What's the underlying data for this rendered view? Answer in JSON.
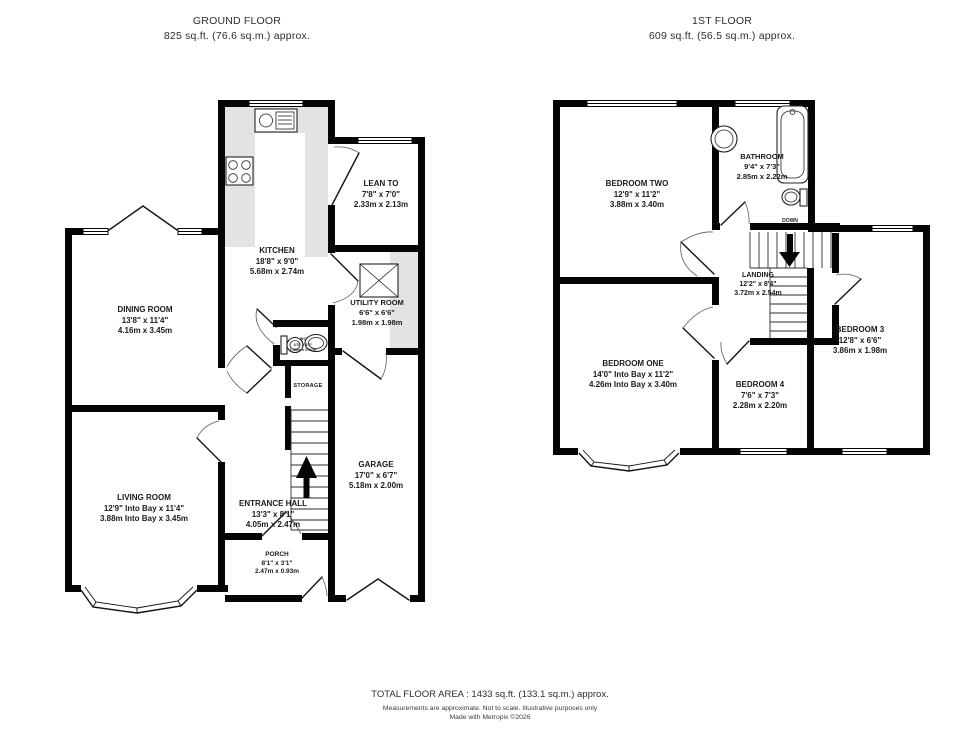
{
  "ground_floor": {
    "title": "GROUND FLOOR",
    "subtitle": "825 sq.ft. (76.6 sq.m.) approx.",
    "rooms": {
      "kitchen": {
        "name": "KITCHEN",
        "imperial": "18'8\" x 9'0\"",
        "metric": "5.68m x 2.74m"
      },
      "lean_to": {
        "name": "LEAN TO",
        "imperial": "7'8\" x 7'0\"",
        "metric": "2.33m x 2.13m"
      },
      "dining": {
        "name": "DINING ROOM",
        "imperial": "13'8\" x 11'4\"",
        "metric": "4.16m x 3.45m"
      },
      "utility": {
        "name": "UTILITY ROOM",
        "imperial": "6'6\" x 6'6\"",
        "metric": "1.98m x 1.98m"
      },
      "wc": {
        "name": "WC",
        "imperial": "4'3\" x 3'2\"",
        "metric": "1.30m x 0.97m"
      },
      "living": {
        "name": "LIVING ROOM",
        "imperial": "12'9\" Into Bay x 11'4\"",
        "metric": "3.88m Into Bay x 3.45m"
      },
      "hall": {
        "name": "ENTRANCE HALL",
        "imperial": "13'3\" x 8'1\"",
        "metric": "4.05m x 2.47m"
      },
      "porch": {
        "name": "PORCH",
        "imperial": "8'1\" x 3'1\"",
        "metric": "2.47m x 0.93m"
      },
      "garage": {
        "name": "GARAGE",
        "imperial": "17'0\" x 6'7\"",
        "metric": "5.18m x 2.00m"
      }
    },
    "labels": {
      "storage": "STORAGE"
    }
  },
  "first_floor": {
    "title": "1ST FLOOR",
    "subtitle": "609 sq.ft. (56.5 sq.m.) approx.",
    "rooms": {
      "bedroom_two": {
        "name": "BEDROOM TWO",
        "imperial": "12'9\" x 11'2\"",
        "metric": "3.88m x 3.40m"
      },
      "bathroom": {
        "name": "BATHROOM",
        "imperial": "9'4\" x 7'3\"",
        "metric": "2.85m x 2.22m"
      },
      "landing": {
        "name": "LANDING",
        "imperial": "12'2\" x 8'4\"",
        "metric": "3.72m x 2.54m"
      },
      "bedroom_3": {
        "name": "BEDROOM 3",
        "imperial": "12'8\" x 6'6\"",
        "metric": "3.86m x 1.98m"
      },
      "bedroom_one": {
        "name": "BEDROOM ONE",
        "imperial": "14'0\" Into Bay x 11'2\"",
        "metric": "4.26m Into Bay x 3.40m"
      },
      "bedroom_4": {
        "name": "BEDROOM 4",
        "imperial": "7'6\" x 7'3\"",
        "metric": "2.28m x 2.20m"
      }
    },
    "labels": {
      "down": "DOWN"
    }
  },
  "footer": {
    "total": "TOTAL FLOOR AREA : 1433 sq.ft. (133.1 sq.m.) approx.",
    "disclaimer": "Measurements are approximate.  Not to scale.  Illustrative purposes only",
    "made_with": "Made with Metropix ©2026"
  }
}
